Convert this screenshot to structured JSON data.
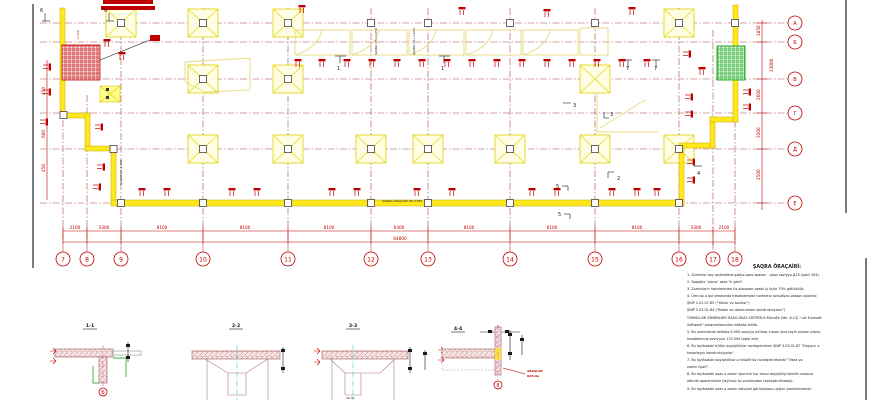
{
  "drawing": {
    "axes_bottom": [
      "7",
      "8",
      "9",
      "10",
      "11",
      "12",
      "13",
      "14",
      "15",
      "16",
      "17",
      "18"
    ],
    "axes_right": [
      "А",
      "Б",
      "В",
      "Г",
      "Д",
      "Е"
    ],
    "dims_bottom": [
      "2100",
      "3300",
      "8100",
      "8100",
      "8100",
      "6400",
      "8100",
      "8100",
      "8100",
      "3300",
      "2100"
    ],
    "dim_total": "64800",
    "dims_right": [
      "1850",
      "23000",
      "2600",
      "3300",
      "2500"
    ],
    "dims_left": [
      "450",
      "600",
      "450"
    ],
    "elevation": "-3,150",
    "markers": {
      "six": "6",
      "one": "1",
      "two": "2",
      "three": "3",
      "four": "4",
      "five": "5",
      "seven": "7"
    },
    "labels": {
      "beam_bottom": "ŞAQRA-ÖRAÇAİRİ 05-0,350",
      "beam_vert1": "ŞAQRA Q5+3,950",
      "beam_vert2": "ŞAQRA Q5+3,950",
      "wall_left": "ŞAQRA Q5-0,350"
    }
  },
  "sections": [
    {
      "title": "1-1",
      "bubble": "Б"
    },
    {
      "title": "2-2"
    },
    {
      "title": "3-3",
      "bottom_dim": "30 30"
    },
    {
      "title": "4-4",
      "bubble": "8",
      "note1": "ƏSASLAR",
      "note2": "Q25-8a"
    }
  ],
  "notes": {
    "heading": "ŞAQRA ÖRAÇAİRİ:",
    "lines": [
      "1. Zəminlər bəy aşılmalarla şəkilə-əsas əsasən - əbəs səviyyə Д25 (şəkil 304).",
      "2. Dəqiqliə \"əlavə\" əsas \"k şəkli\".",
      "3. Zəminlərin hazırlanması ilə əlaqədar əsaslı iş üçün 70% götürülüb.",
      "4. Ümr-də ə qurulmasında hesablamalar normativ sənədlərə əsasən aparılıb:",
      "ŞNİP 2.01.07-85 (\"Yüklər və təsirlər\")",
      "ŞNİP 2.03.01-84 (\"Beton və dəmir-beton konstruksiyalar\")",
      "TƏMƏLLƏR ZƏMİNLƏRİ ƏSAS-ƏSAS SİSTEMLƏ MicroFe (Ver. 6.13) \"-ub Eurosoft",
      "Software\" proqramlarından istifadə edilib.",
      "5. Bu zəminlərdə istifadə 0.000 səviyyə mütləq +əsas üzrə təyin olunan plana,",
      "hesablanmış səviyyəsi 170.300 təşkil edir.",
      "6. Bu layihədəki bütün dəyişikliklər razılaşdırılmalı ŞNİP 3.03.01-87 \"Daşıyıcı ə",
      "hasarlayıcı konstruksiyalar\"",
      "7. Bu layihədəki dəyişikliklər ə müəllif ilə razılaşdırılmalıdır \"Əsas və",
      "zəmin işləri\".",
      "8. Bu layihədəki əsas ə zəmin işlərinin hər hansı dəyişikliyi texniki nəzarət",
      "altında aparılmalıdır (layihəçi ilə əvvəlcədən razılaşdırılmaqla).",
      "9. Bu layihədəki əsas ə zəmin sahələri görünüşlərə uyğun yoxlanılmalıdır."
    ]
  }
}
